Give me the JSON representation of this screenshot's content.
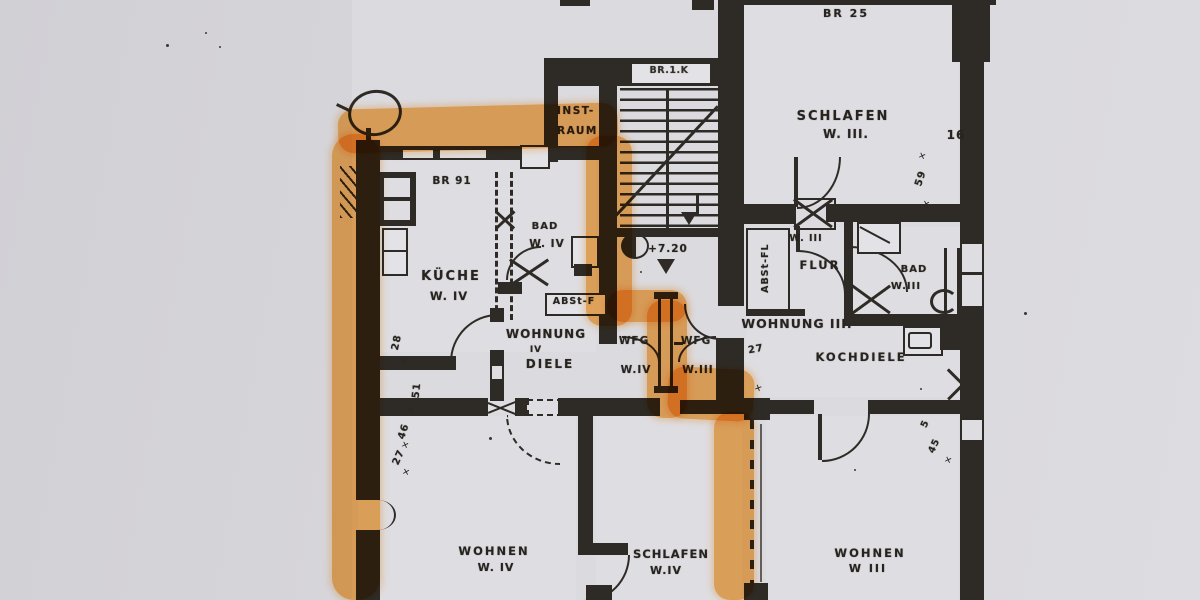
{
  "document": {
    "kind_label": "Grundriss-Scan (Wohnungsplan)"
  },
  "colors": {
    "paper": "#d6d5da",
    "paper_light": "#dedde1",
    "ink": "#2e2b26",
    "highlighter": "#f7a140"
  },
  "labels": {
    "br25": "BR 25",
    "schlafen_w3_1": "SCHLAFEN",
    "schlafen_w3_2": "W. III.",
    "dim16": "16",
    "dim59": "59",
    "br1k": "BR.1.K",
    "inst_1": "INST-",
    "inst_2": "RAUM",
    "br91": "BR 91",
    "bad_w4_1": "BAD",
    "bad_w4_2": "W. IV",
    "kueche_1": "KÜCHE",
    "kueche_2": "W. IV",
    "abst_f": "ABSt-F",
    "abst_fl": "ABSt-FL",
    "flur_small": "W. III",
    "flur": "FLUR",
    "level": "+7.20",
    "bad_w3_1": "BAD",
    "bad_w3_2": "W.III",
    "wohnung4_1": "WOHNUNG",
    "wohnung4_num": "IV",
    "wohnung4_2": "DIELE",
    "wfg_w4_1": "WFG",
    "wfg_w4_2": "W.IV",
    "wfg_w3_1": "WFG",
    "wfg_w3_2": "W.III",
    "wohnung3": "WOHNUNG III.",
    "kochdiele": "KOCHDIELE",
    "dim28": "28",
    "dim51": "51",
    "dim46": "46",
    "dim27a": "27",
    "dim27b": "27",
    "dim45": "45",
    "dim5": "5",
    "wohnen_w4_1": "WOHNEN",
    "wohnen_w4_2": "W. IV",
    "schlafen_w4_1": "SCHLAFEN",
    "schlafen_w4_2": "W.IV",
    "wohnen_w3_1": "WOHNEN",
    "wohnen_w3_2": "W III"
  }
}
